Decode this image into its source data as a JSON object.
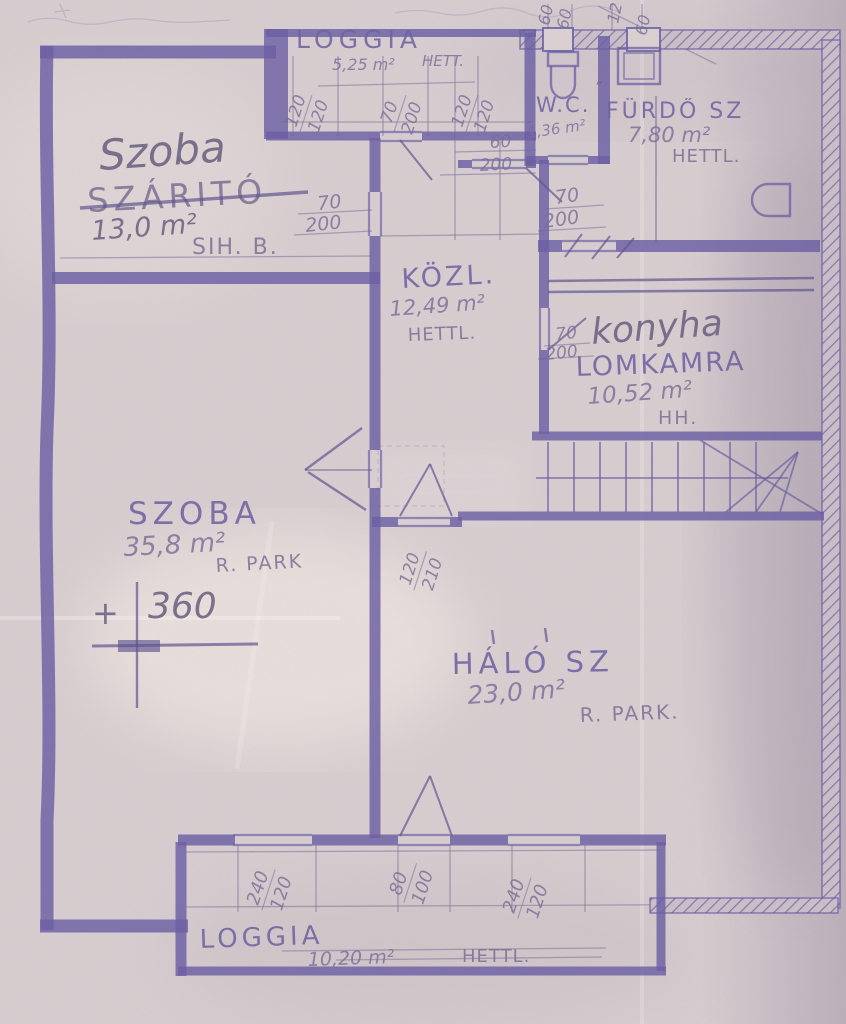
{
  "drawing": {
    "kind": "floor-plan",
    "language": "hungarian"
  },
  "colors": {
    "paper": "#d5cacc",
    "ink": "#6b5fa4",
    "pencil": "#7d7198",
    "handwriting": "#6e6583"
  },
  "rooms": {
    "szoba_felso": {
      "name": "Szoba",
      "old_name": "SZÁRITÓ",
      "area": "13,0 m²",
      "note": "SIH. B."
    },
    "loggia_felso": {
      "name": "LOGGIA",
      "area": "5,25 m²",
      "floor": "HETT."
    },
    "wc": {
      "name": "W.C.",
      "area": "1,36 m²"
    },
    "furdo": {
      "name": "FÜRDŐ SZ",
      "mark": "″",
      "area": "7,80 m²",
      "floor": "HETTL."
    },
    "kozl": {
      "name": "KÖZL.",
      "area": "12,49 m²",
      "floor": "HETTL."
    },
    "konyha": {
      "name": "konyha",
      "old_name": "LOMKAMRA",
      "area": "10,52 m²",
      "floor": "HH."
    },
    "szoba_nagy": {
      "name": "SZOBA",
      "area": "35,8 m²",
      "floor": "R. PARK"
    },
    "halo": {
      "name": "HÁLÓ SZ",
      "area": "23,0 m²",
      "floor": "R. PARK."
    },
    "loggia_also": {
      "name": "LOGGIA",
      "area": "10,20 m²",
      "floor": "HETTL."
    }
  },
  "level_marker": {
    "sign": "+",
    "value": "360"
  },
  "dimensions": {
    "loggia_top_left": {
      "w": "120",
      "h": "120"
    },
    "loggia_top_mid": {
      "w": "70",
      "h": "200"
    },
    "loggia_top_right": {
      "w": "120",
      "h": "120"
    },
    "shaft_left": {
      "w": "60",
      "h": "60"
    },
    "shaft_right": {
      "w": "12",
      "h": "60"
    },
    "entry_door": {
      "w": "60",
      "h": "200"
    },
    "bath_door": {
      "w": "70",
      "h": "200"
    },
    "szoba_door": {
      "w": "70",
      "h": "200"
    },
    "konyha_door": {
      "w": "70",
      "h": "200"
    },
    "halo_door": {
      "w": "120",
      "h": "210"
    },
    "bottom_window_left": {
      "w": "240",
      "h": "120"
    },
    "bottom_window_mid": {
      "w": "80",
      "h": "100"
    },
    "bottom_window_right": {
      "w": "240",
      "h": "120"
    }
  }
}
